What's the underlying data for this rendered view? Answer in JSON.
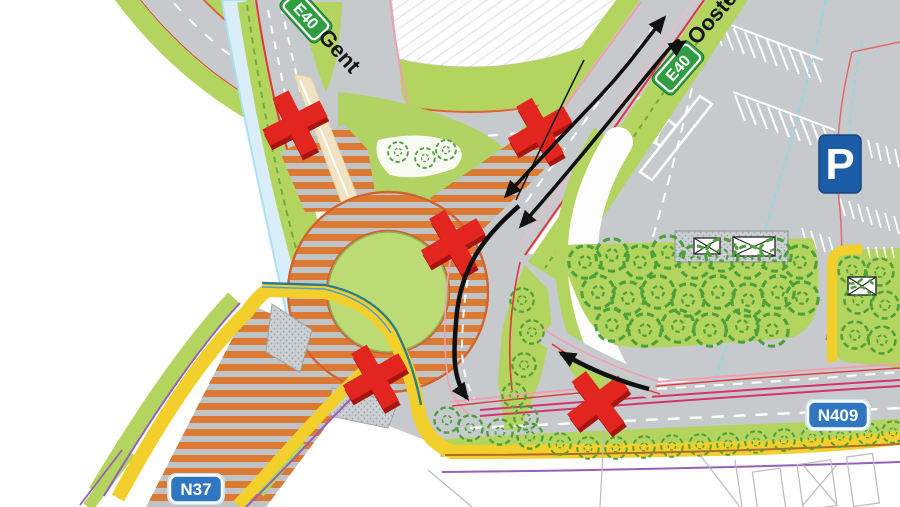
{
  "map_labels": {
    "e40_west_badge": "E40",
    "e40_west_destination": "Gent",
    "e40_east_badge": "E40",
    "e40_east_destination": "Oostende",
    "n409_badge": "N409",
    "n37_badge": "N37",
    "parking_sign": "P"
  },
  "annotations": {
    "closure_marks_count": 5,
    "closure_positions_px": [
      [
        295,
        123
      ],
      [
        540,
        130
      ],
      [
        453,
        242
      ],
      [
        375,
        377
      ],
      [
        598,
        402
      ]
    ],
    "detour_arrow_count": 4
  },
  "colors": {
    "construction_hatch_orange": "#dc7a33",
    "grass_green": "#b3d45f",
    "road_gray": "#c7cacc",
    "closure_red": "#e2251f",
    "cycleway_yellow": "#f2cf2b",
    "route_badge_blue": "#2f77c0",
    "e40_badge_green": "#2f9e41",
    "parking_sign_blue": "#1c5da8",
    "water_blue": "#d9eef8"
  }
}
